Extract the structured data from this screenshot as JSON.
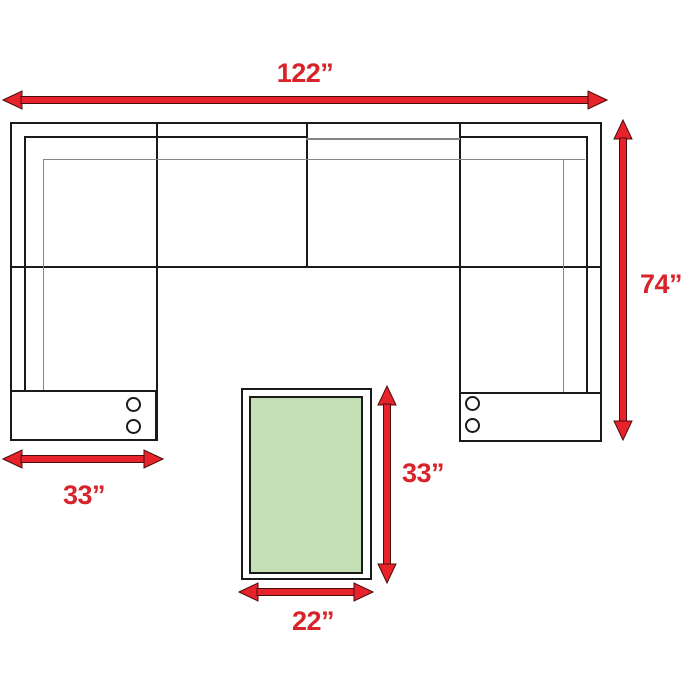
{
  "dimensions": {
    "overall_width": "122”",
    "overall_depth": "74”",
    "arm_section_width": "33”",
    "ottoman_length": "33”",
    "ottoman_width": "22”"
  },
  "colors": {
    "arrow_red": "#e8222a",
    "label_red": "#d8232a",
    "ottoman_green": "#c5dfb6",
    "line_black": "#1a1a1a",
    "line_gray": "#858585"
  }
}
